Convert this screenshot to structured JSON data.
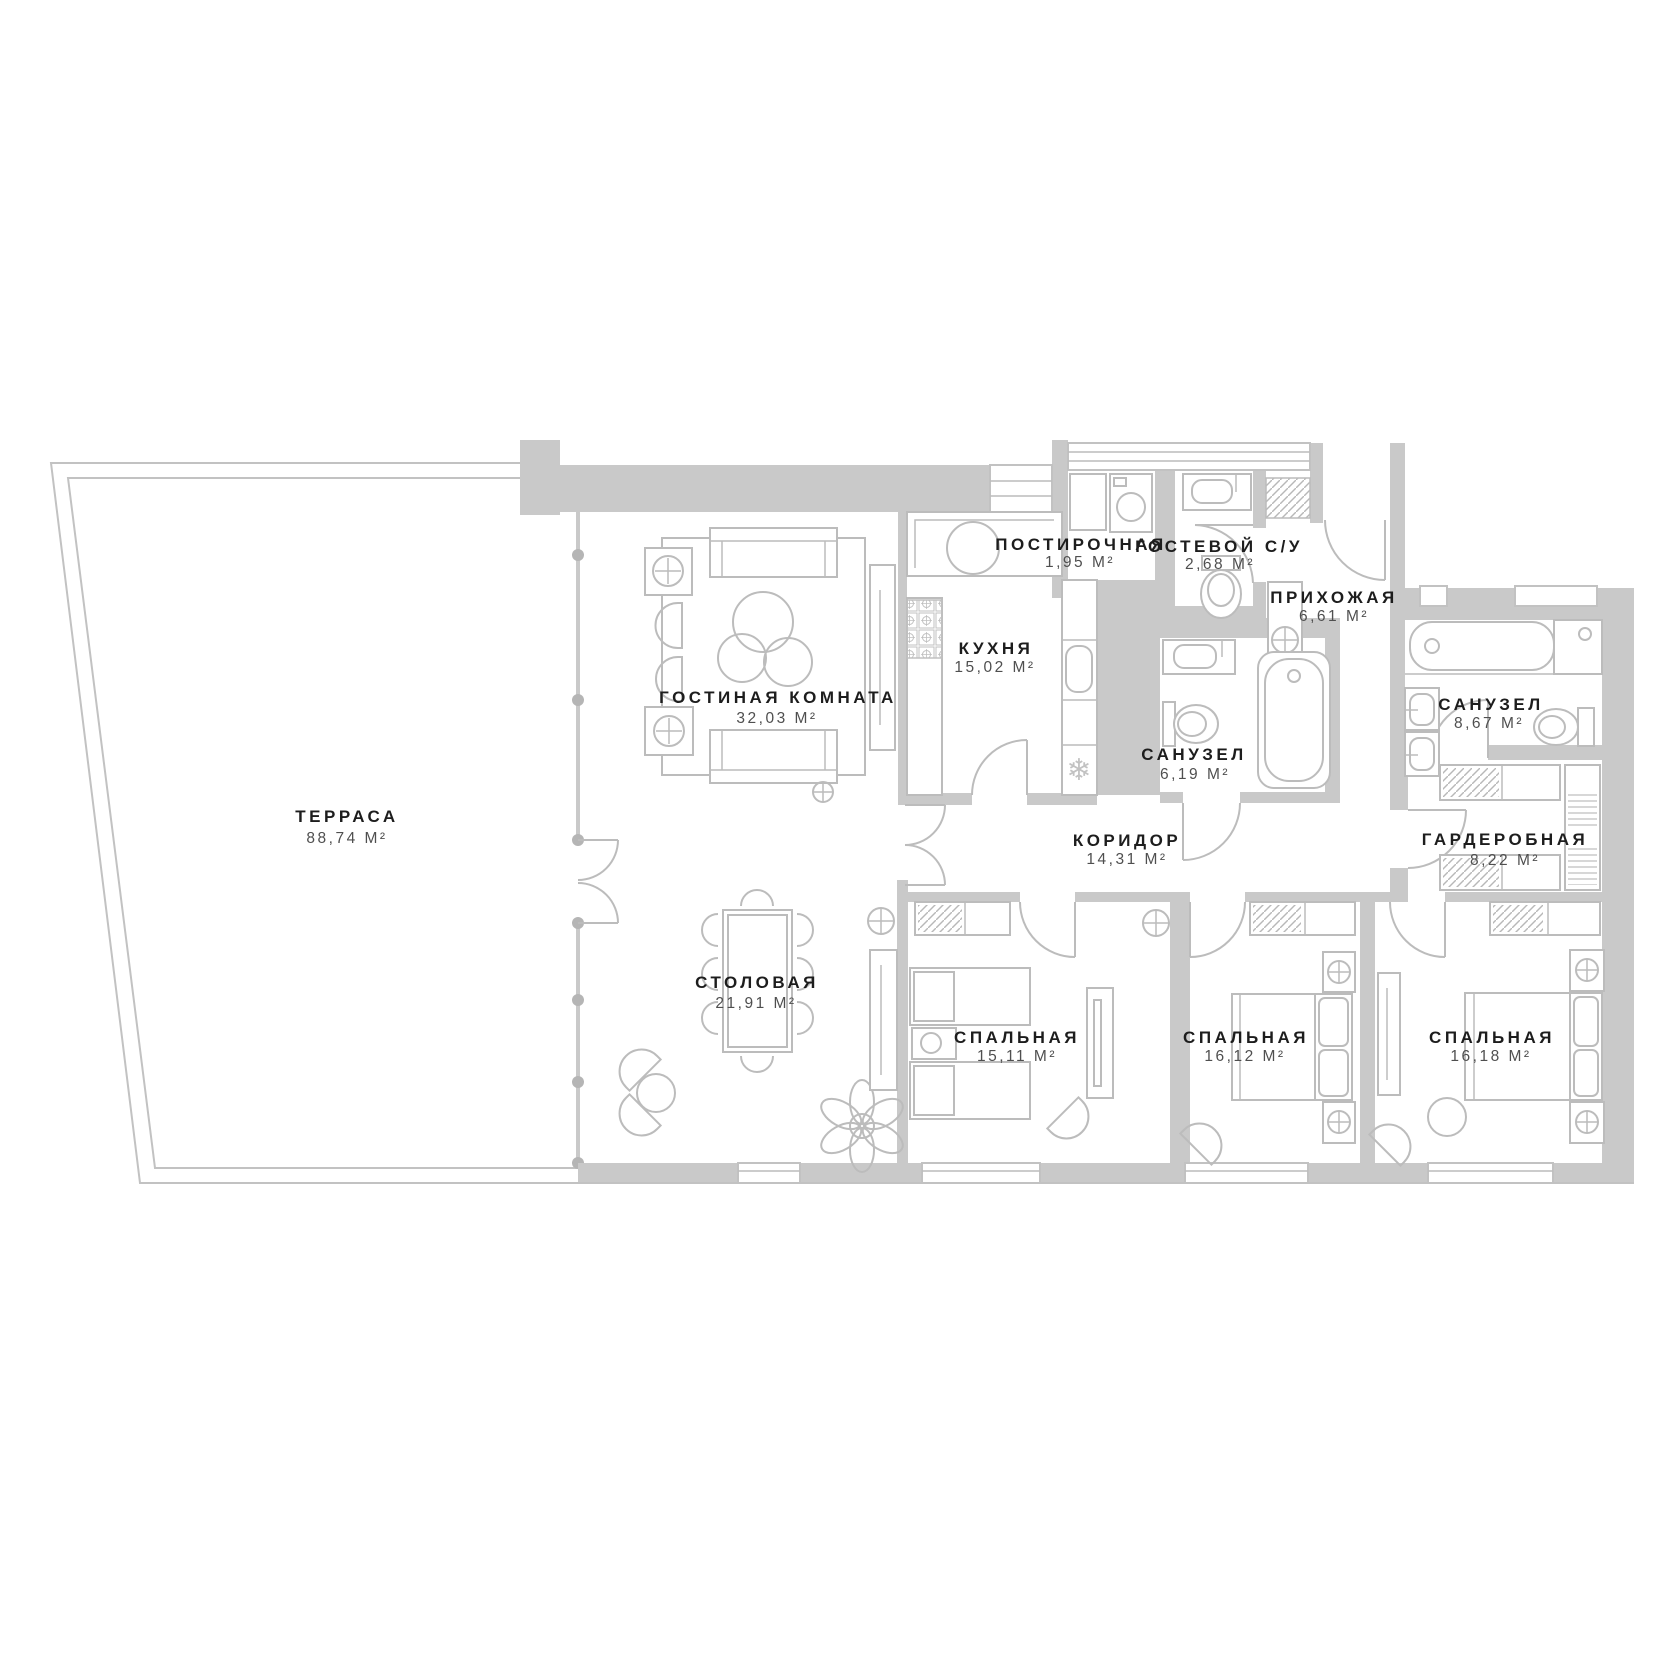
{
  "plan": {
    "type": "apartment-floor-plan",
    "area_unit": "М²",
    "rooms": [
      {
        "name": "ТЕРРАСА",
        "area": "88,74 М²"
      },
      {
        "name": "ГОСТИНАЯ КОМНАТА",
        "area": "32,03 М²"
      },
      {
        "name": "КУХНЯ",
        "area": "15,02 М²"
      },
      {
        "name": "ПОСТИРОЧНАЯ",
        "area": "1,95 М²"
      },
      {
        "name": "ГОСТЕВОЙ С/У",
        "area": "2,68 М²"
      },
      {
        "name": "ПРИХОЖАЯ",
        "area": "6,61 М²"
      },
      {
        "name": "САНУЗЕЛ",
        "area": "6,19 М²"
      },
      {
        "name": "САНУЗЕЛ",
        "area": "8,67 М²"
      },
      {
        "name": "КОРИДОР",
        "area": "14,31 М²"
      },
      {
        "name": "ГАРДЕРОБНАЯ",
        "area": "8,22 М²"
      },
      {
        "name": "СТОЛОВАЯ",
        "area": "21,91 М²"
      },
      {
        "name": "СПАЛЬНАЯ",
        "area": "15,11 М²"
      },
      {
        "name": "СПАЛЬНАЯ",
        "area": "16,12 М²"
      },
      {
        "name": "СПАЛЬНАЯ",
        "area": "16,18 М²"
      }
    ],
    "icons": {
      "fridge_snowflake": "❄"
    }
  },
  "colors": {
    "background": "#ffffff",
    "wall": "#c9c9c9",
    "outline": "#c2c2c2",
    "furniture_line": "#bcbcbc",
    "label_text": "#1d1d1d",
    "area_text": "#4f4f4f"
  }
}
